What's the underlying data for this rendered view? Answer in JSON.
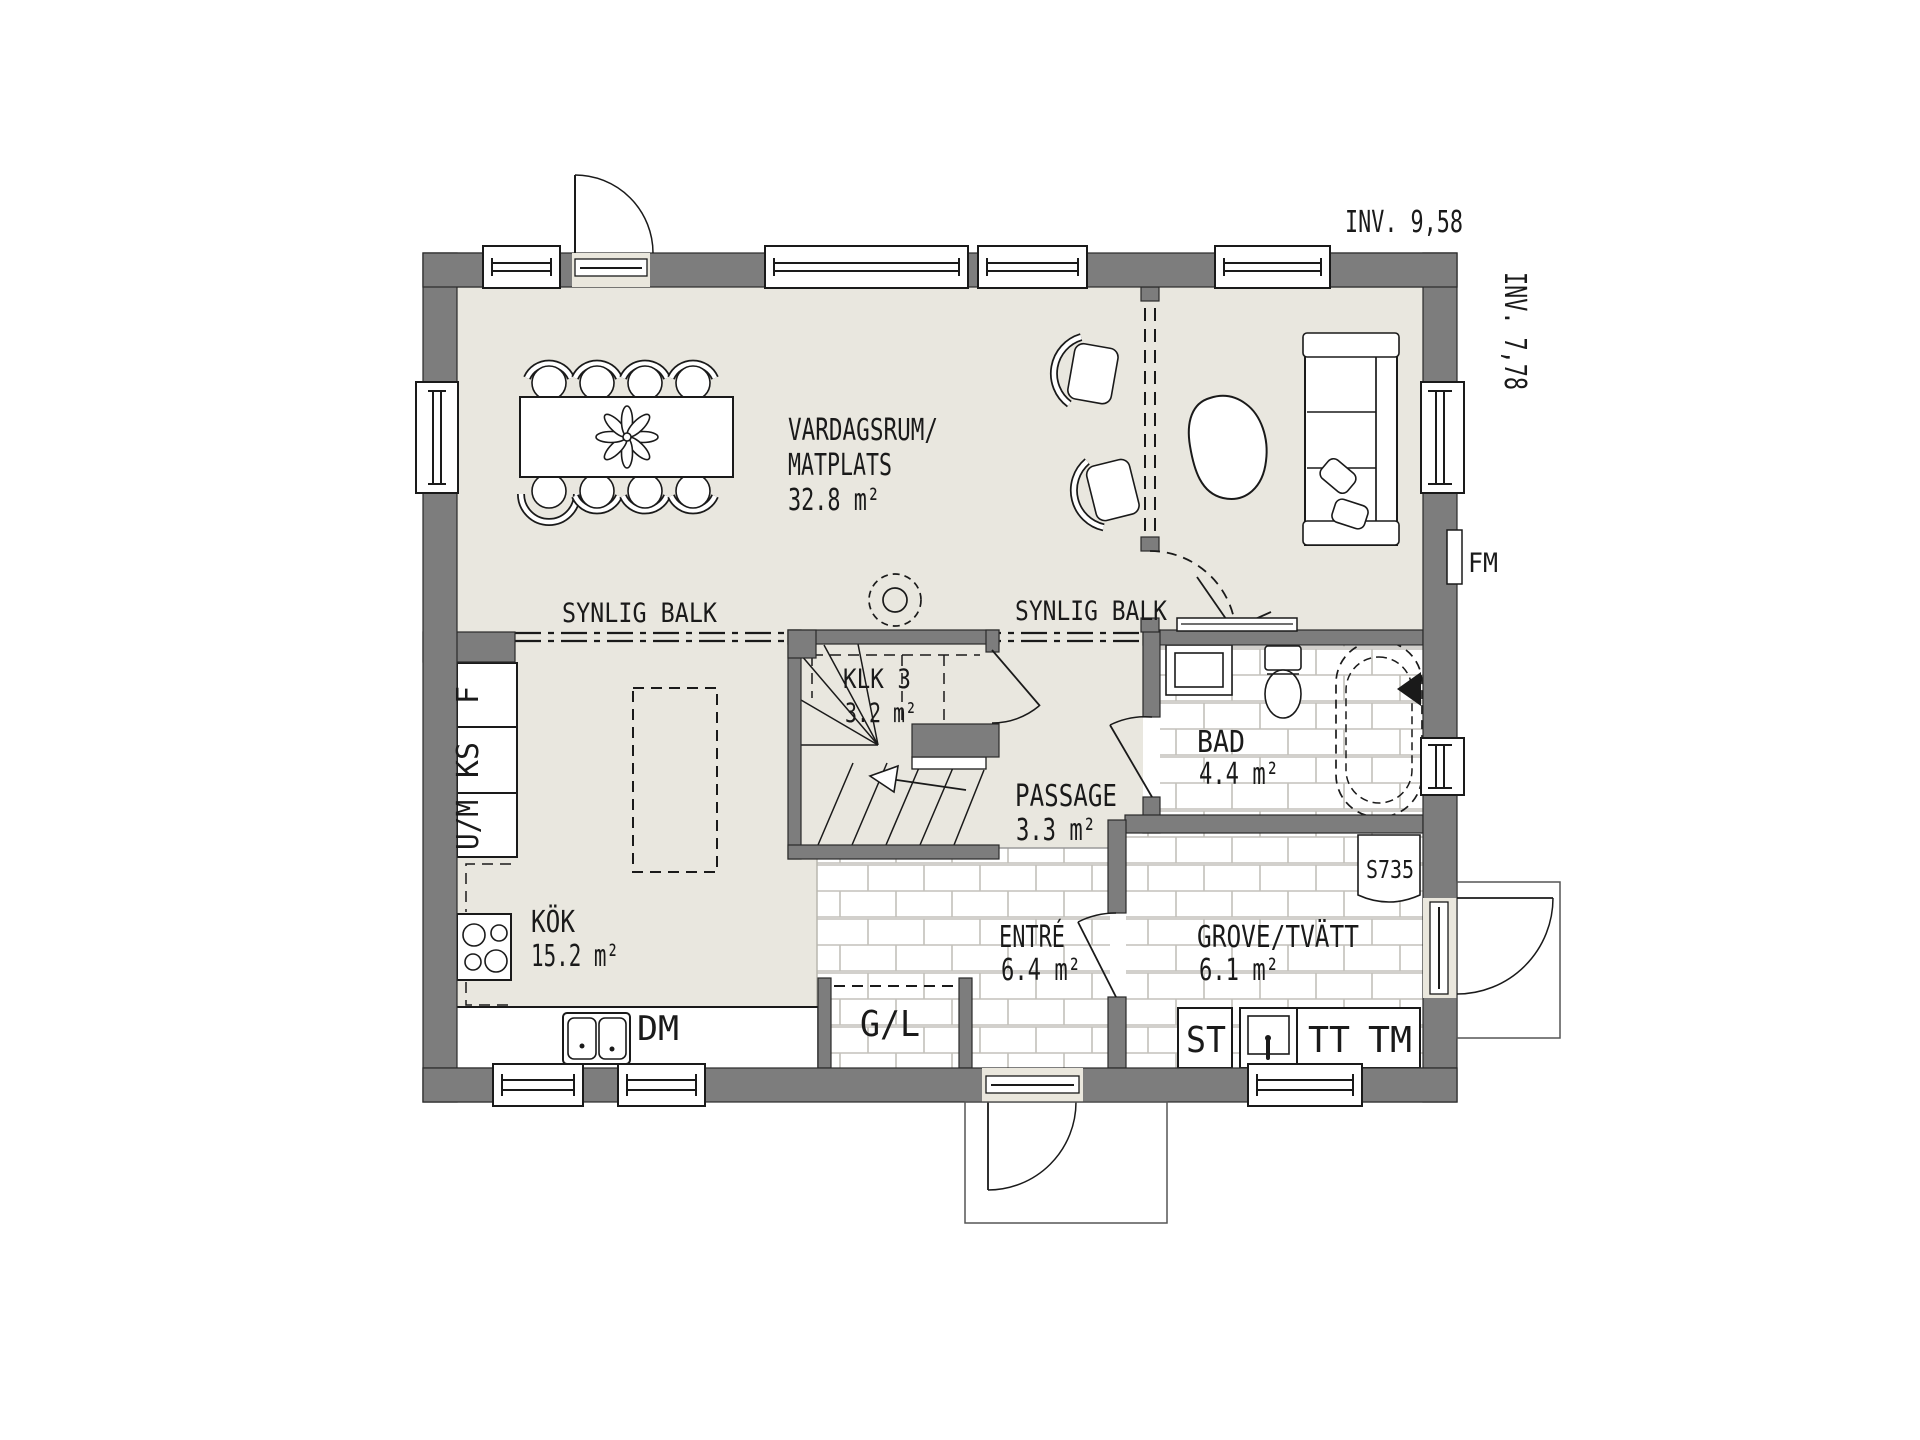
{
  "labels": {
    "inv_width": "INV. 9,58",
    "inv_height": "INV. 7,78",
    "living_name_1": "VARDAGSRUM/",
    "living_name_2": "MATPLATS",
    "living_area": "32.8 m²",
    "beam_left": "SYNLIG BALK",
    "beam_right": "SYNLIG BALK",
    "stair_closet_name": "KLK 3",
    "stair_closet_area": "3.2 m²",
    "passage_name": "PASSAGE",
    "passage_area": "3.3 m²",
    "bath_name": "BAD",
    "bath_area": "4.4 m²",
    "kitchen_name": "KÖK",
    "kitchen_area": "15.2 m²",
    "entry_name": "ENTRÉ",
    "entry_area": "6.4 m²",
    "laundry_name": "GROVE/TVÄTT",
    "laundry_area": "6.1 m²",
    "dishwasher": "DM",
    "wardrobe": "G/L",
    "storage": "ST",
    "tumble_dryer": "TT",
    "washing_machine": "TM",
    "water_heater": "S735",
    "manifold": "FM",
    "fridge": "F",
    "cooler": "KS",
    "oven_micro": "U/M"
  },
  "colors": {
    "wall": "#7d7d7d",
    "floor": "#e9e7df",
    "line": "#1a1a1a",
    "tile_line": "#c3c1bb",
    "door_fill": "#eae7dd"
  }
}
